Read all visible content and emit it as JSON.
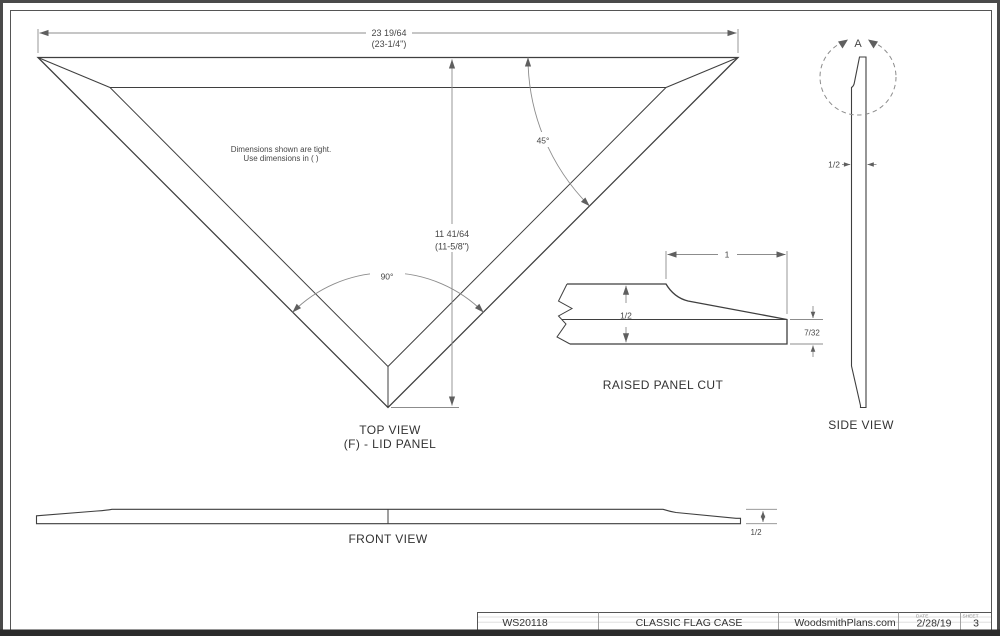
{
  "colors": {
    "line": "#3f3f3f",
    "dim": "#8c8c8c",
    "arrow": "#5f5f5f",
    "dim_text": "#474747",
    "label_text": "#333333",
    "frame": "#4a4a4a",
    "frame_bottom": "#2b2b2b",
    "inner_border": "#555555",
    "faint": "#d9d9d9",
    "background": "#ffffff"
  },
  "top_view": {
    "width_dim": "23 19/64",
    "width_dim_alt": "(23-1/4\")",
    "height_dim": "11 41/64",
    "height_dim_alt": "(11-5/8\")",
    "angle_edge": "45°",
    "angle_vertex": "90°",
    "note_line1": "Dimensions shown are tight.",
    "note_line2": "Use dimensions in ( )",
    "label": "TOP VIEW",
    "sublabel": "(F) - LID PANEL"
  },
  "raised_panel": {
    "label": "RAISED PANEL CUT",
    "dim_width": "1",
    "dim_thickness": "1/2",
    "dim_edge": "7/32"
  },
  "side_view": {
    "label": "SIDE VIEW",
    "detail_marker": "A",
    "dim_thickness": "1/2"
  },
  "front_view": {
    "label": "FRONT VIEW",
    "dim_thickness": "1/2"
  },
  "title_block": {
    "plan_number": "WS20118",
    "title": "CLASSIC FLAG CASE",
    "website": "WoodsmithPlans.com",
    "date_label": "DATE",
    "date": "2/28/19",
    "sheet_label": "SHEET",
    "sheet": "3"
  }
}
